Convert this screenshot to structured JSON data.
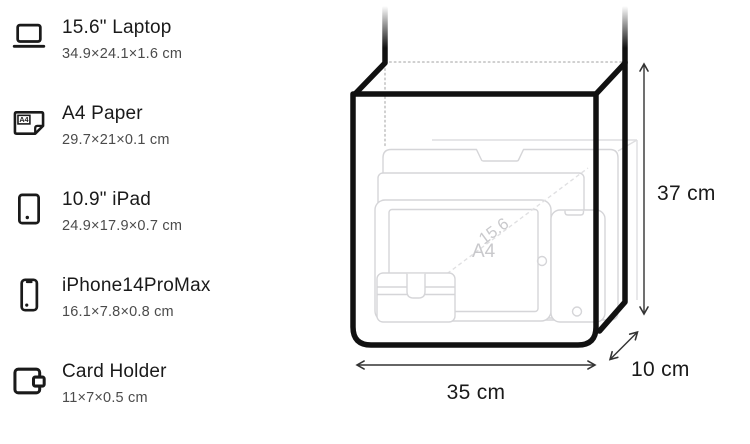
{
  "sidebar": {
    "items": [
      {
        "name": "15.6\" Laptop",
        "dimensions": "34.9×24.1×1.6 cm",
        "icon": "laptop-icon"
      },
      {
        "name": "A4 Paper",
        "dimensions": "29.7×21×0.1 cm",
        "icon": "a4-paper-icon",
        "icon_label": "A4"
      },
      {
        "name": "10.9\" iPad",
        "dimensions": "24.9×17.9×0.7 cm",
        "icon": "ipad-icon"
      },
      {
        "name": "iPhone14ProMax",
        "dimensions": "16.1×7.8×0.8 cm",
        "icon": "iphone-icon"
      },
      {
        "name": "Card Holder",
        "dimensions": "11×7×0.5 cm",
        "icon": "card-holder-icon"
      }
    ]
  },
  "diagram": {
    "bag": {
      "width_label": "35 cm",
      "height_label": "37 cm",
      "depth_label": "10 cm"
    },
    "inner_labels": {
      "a4": "A4",
      "laptop_diagonal": "15.6"
    },
    "colors": {
      "bag_outline": "#111111",
      "item_outline": "#d5d5d8",
      "dimension_line": "#333333",
      "text": "#1a1a1a",
      "secondary_text": "#4b4b4b",
      "faint_label": "#c9c9cc"
    }
  }
}
